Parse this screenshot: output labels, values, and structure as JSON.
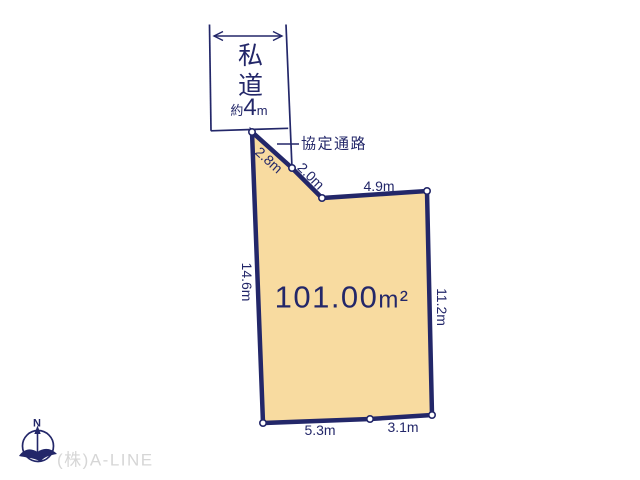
{
  "parcel": {
    "area_value": "101.00",
    "area_unit": "m²",
    "dimensions": {
      "upper_left_1": "2.8m",
      "upper_left_2": "2.0m",
      "top": "4.9m",
      "left": "14.6m",
      "right": "11.2m",
      "bottom_left": "5.3m",
      "bottom_right": "3.1m"
    }
  },
  "private_road": {
    "label": "私道",
    "width_prefix": "約",
    "width_value": "4",
    "width_unit": "m"
  },
  "passage_label": "協定通路",
  "compass_north": "N",
  "company": "(株)A-LINE",
  "colors": {
    "line": "#232769",
    "parcel_fill": "#f8dba0",
    "muted_text": "#d6d6d6",
    "background": "#ffffff"
  }
}
